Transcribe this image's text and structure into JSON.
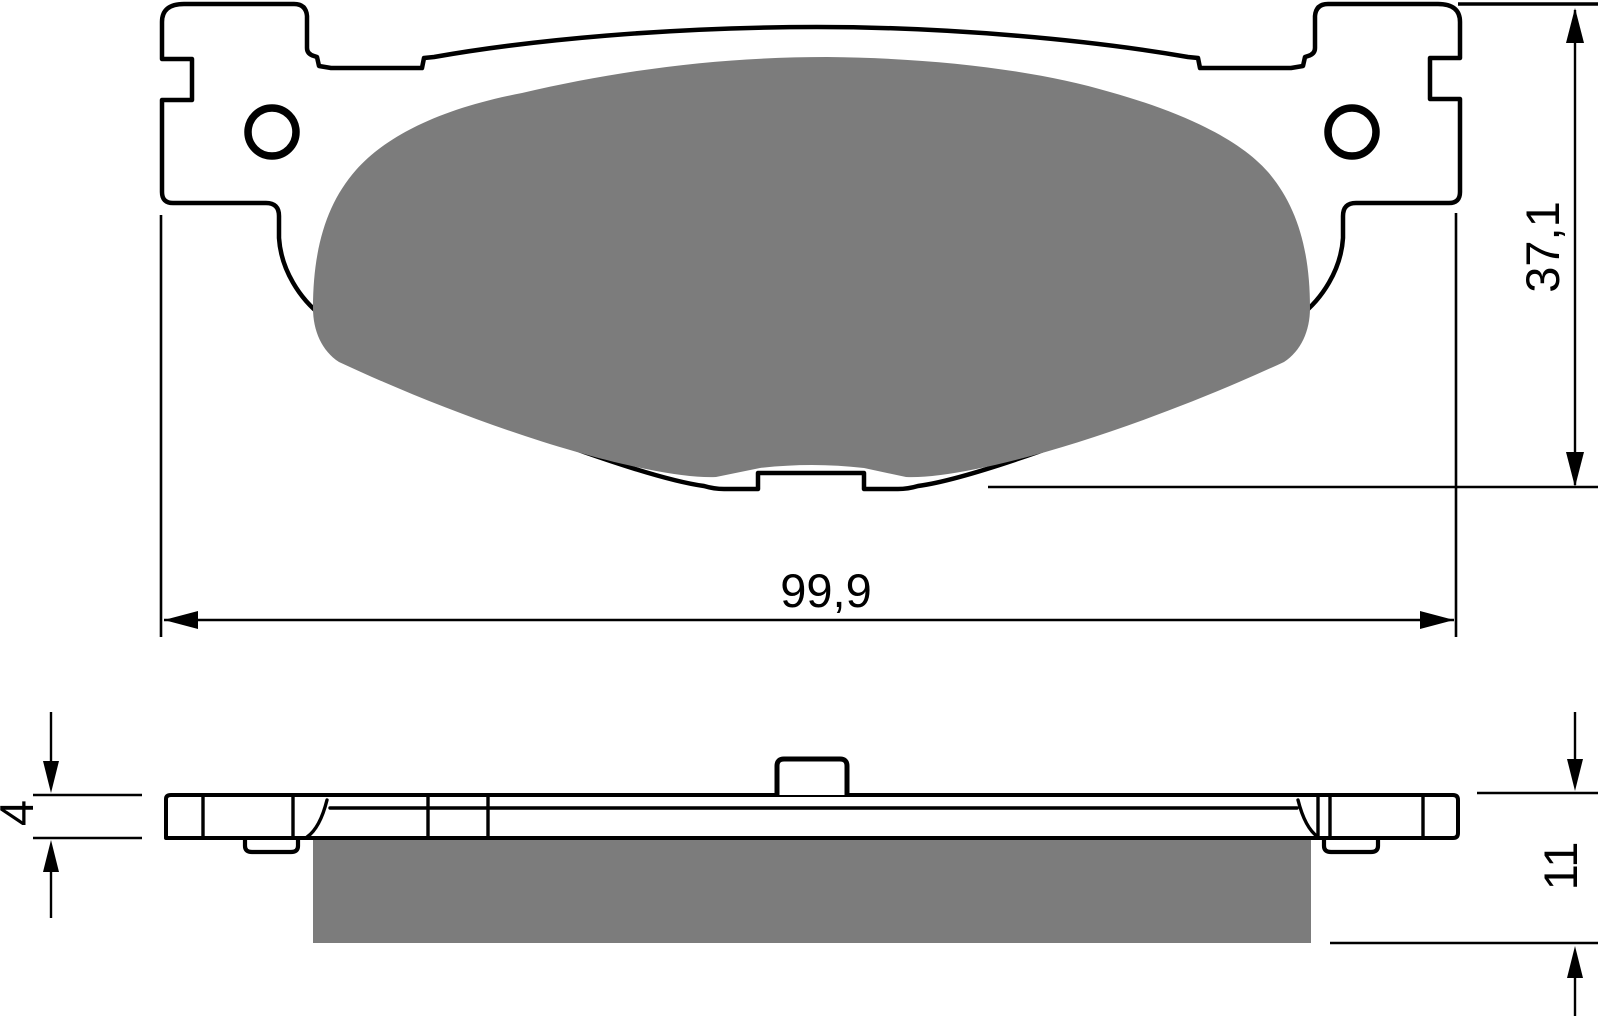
{
  "drawing": {
    "kind": "brake-pad-dimensional-drawing",
    "dimensions": {
      "width": "99,9",
      "height": "37,1",
      "backplate_thickness": "4",
      "total_thickness": "11"
    },
    "colors": {
      "line": "#000000",
      "friction_material": "#7c7c7c",
      "background": "#ffffff"
    }
  }
}
